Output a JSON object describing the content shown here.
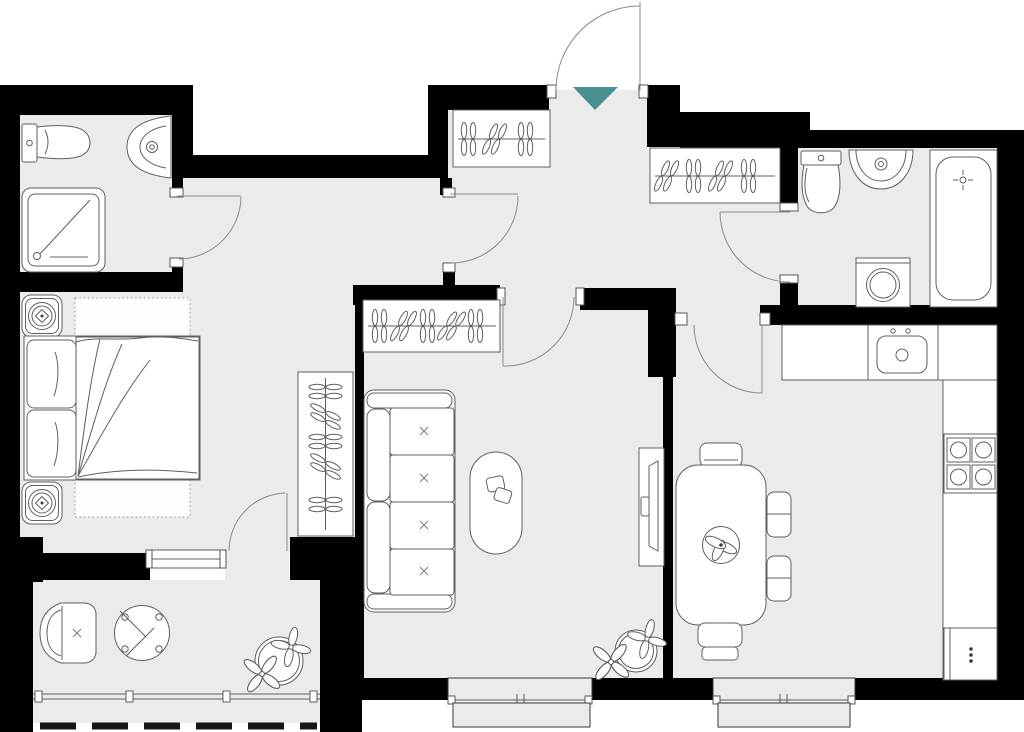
{
  "title": "apartment-floor-plan",
  "canvas": {
    "width": 1024,
    "height": 732
  },
  "colors": {
    "wall": "#000000",
    "floor": "#ebebeb",
    "fixture": "#ffffff",
    "stroke": "#5f5f5f",
    "entrance_arrow": "#4a8f92",
    "outside": "#ffffff",
    "dash": "#151515"
  },
  "entrance": {
    "marker": "teal-triangle",
    "direction": "down-into-hallway"
  },
  "rooms": [
    {
      "id": "bathroom-small",
      "position": "top-left",
      "fixtures": [
        "toilet",
        "corner-basin",
        "shower-cabin"
      ],
      "doors": 1
    },
    {
      "id": "bedroom",
      "position": "left",
      "fixtures": [
        "double-bed",
        "rug",
        "nightstand-lamp",
        "nightstand-lamp",
        "wardrobe-rail"
      ],
      "doors": 2
    },
    {
      "id": "balcony",
      "position": "bottom-left",
      "fixtures": [
        "armchair",
        "round-table",
        "potted-plant",
        "railing",
        "glazing-dashed-edge"
      ],
      "doors": 0
    },
    {
      "id": "entrance-hall",
      "position": "top-center",
      "fixtures": [
        "wardrobe-rail",
        "wardrobe-rail",
        "entrance-door"
      ],
      "doors": 4
    },
    {
      "id": "living-room",
      "position": "center",
      "fixtures": [
        "wardrobe-rail",
        "sofa-four-seat",
        "coffee-table",
        "tv-stand",
        "potted-plant",
        "window"
      ],
      "doors": 1
    },
    {
      "id": "bathroom-large",
      "position": "top-right",
      "fixtures": [
        "toilet",
        "basin",
        "washing-machine",
        "bathtub"
      ],
      "doors": 1
    },
    {
      "id": "kitchen",
      "position": "right",
      "fixtures": [
        "worktop-sink",
        "hob-four-burner",
        "tall-counter",
        "fridge",
        "dining-table",
        "chair",
        "chair",
        "chair",
        "chair",
        "potted-plant",
        "window"
      ],
      "doors": 1
    }
  ]
}
